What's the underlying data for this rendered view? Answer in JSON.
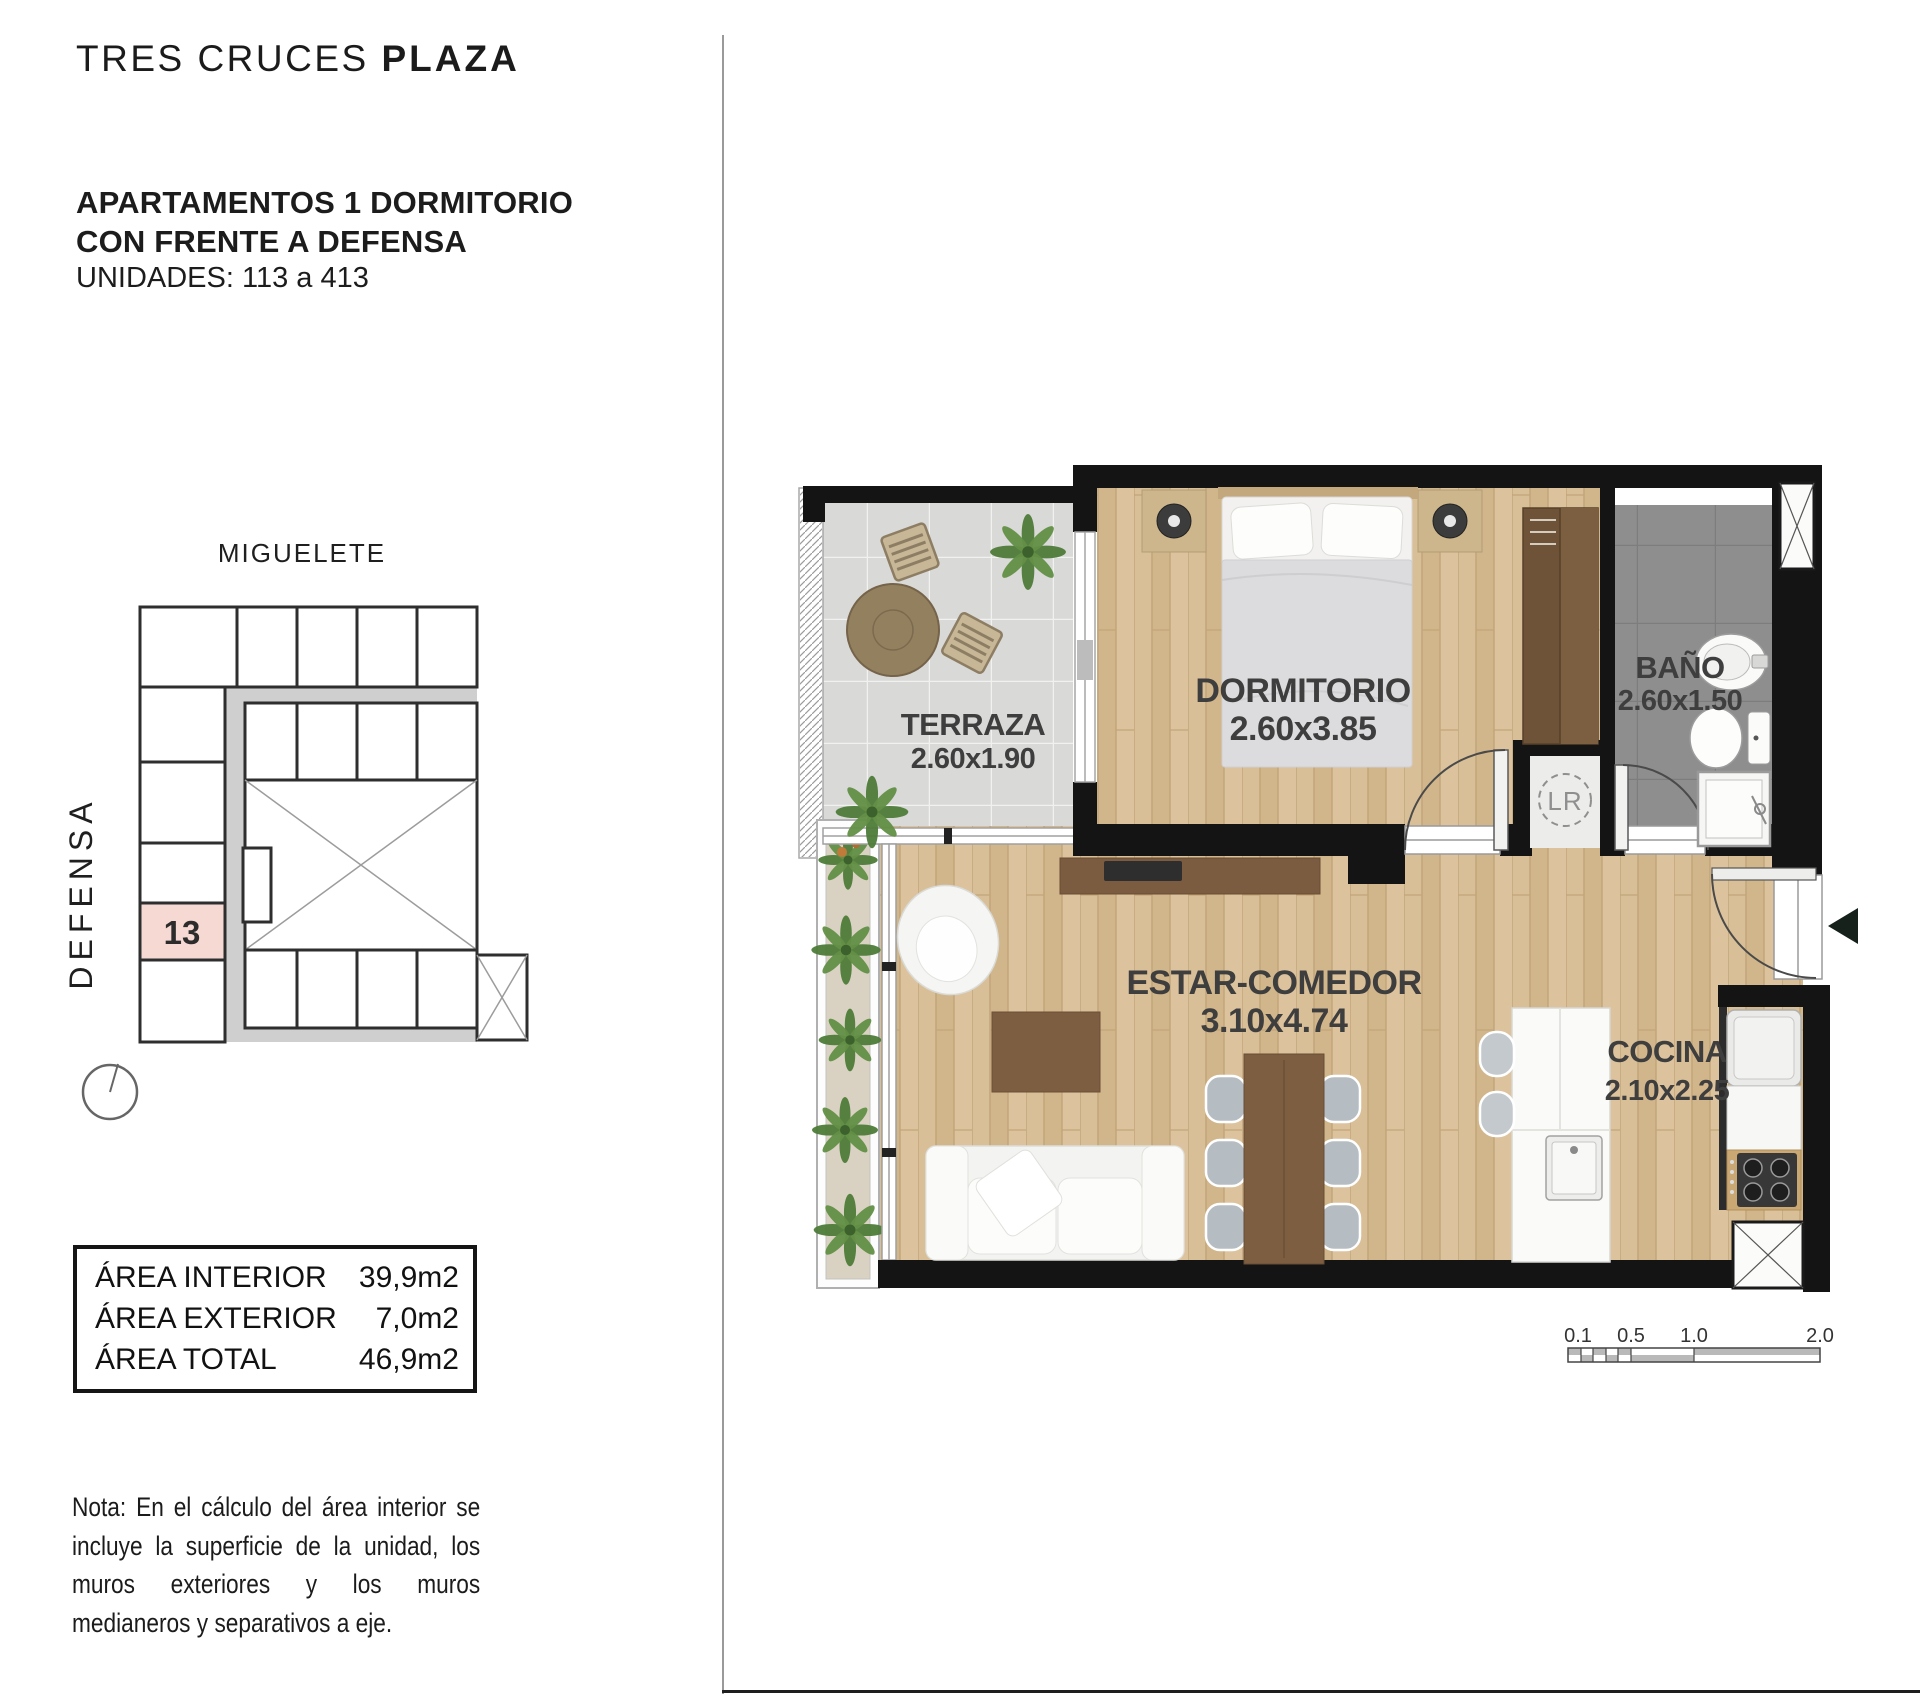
{
  "header": {
    "brand": {
      "regular": "TRES CRUCES",
      "bold": "PLAZA"
    },
    "title_line1": "APARTAMENTOS 1 DORMITORIO",
    "title_line2": "CON FRENTE A DEFENSA",
    "units": "UNIDADES: 113 a 413"
  },
  "site_plan": {
    "street_top": "MIGUELETE",
    "street_left": "DEFENSA",
    "unit_number": "13"
  },
  "area_table": {
    "rows": [
      {
        "label": "ÁREA INTERIOR",
        "value": "39,9m2"
      },
      {
        "label": "ÁREA EXTERIOR",
        "value": "7,0m2"
      },
      {
        "label": "ÁREA TOTAL",
        "value": "46,9m2"
      }
    ]
  },
  "note": {
    "lines": [
      "Nota: En el cálculo del área interior se",
      "incluye la superficie de la unidad, los",
      "muros exteriores y los muros",
      "medianeros y separativos a eje."
    ]
  },
  "floor_plan": {
    "rooms": [
      {
        "name": "TERRAZA",
        "dims": "2.60x1.90"
      },
      {
        "name": "DORMITORIO",
        "dims": "2.60x3.85"
      },
      {
        "name": "BAÑO",
        "dims": "2.60x1.50"
      },
      {
        "name": "ESTAR-COMEDOR",
        "dims": "3.10x4.74"
      },
      {
        "name": "COCINA",
        "dims": "2.10x2.25"
      }
    ],
    "laundry_label": "LR",
    "scale_bar": {
      "ticks": [
        "0.1",
        "0.5",
        "1.0",
        "2.0"
      ]
    }
  },
  "colors": {
    "wall": "#141414",
    "wood_floor": "#d9bf97",
    "tile_light": "#d9d9d7",
    "tile_dark": "#8e8e8e",
    "unit_highlight": "#f7d9d3",
    "plant_green": "#4f7d39"
  }
}
